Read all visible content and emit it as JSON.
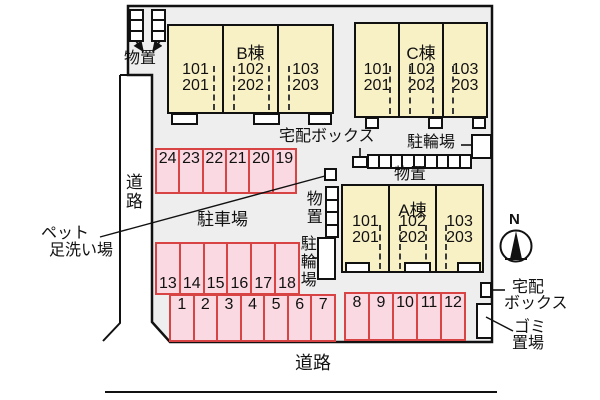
{
  "colors": {
    "background": "#ffffff",
    "site_fill": "#eeeeee",
    "line": "#111111",
    "text": "#111111",
    "building_fill": "#f9f1c6",
    "parking_fill": "#fbd9e2",
    "parking_border": "#d84444"
  },
  "roads": {
    "left": "道路",
    "bottom": "道路"
  },
  "buildings": [
    {
      "name": "B棟",
      "units": [
        {
          "l1": "101",
          "l2": "201"
        },
        {
          "l1": "102",
          "l2": "202"
        },
        {
          "l1": "103",
          "l2": "203"
        }
      ]
    },
    {
      "name": "C棟",
      "units": [
        {
          "l1": "101",
          "l2": "201"
        },
        {
          "l1": "102",
          "l2": "202"
        },
        {
          "l1": "103",
          "l2": "203"
        }
      ]
    },
    {
      "name": "A棟",
      "units": [
        {
          "l1": "101",
          "l2": "201"
        },
        {
          "l1": "102",
          "l2": "202"
        },
        {
          "l1": "103",
          "l2": "203"
        }
      ]
    }
  ],
  "parking": {
    "area_label": "駐車場",
    "row_back": [
      "24",
      "23",
      "22",
      "21",
      "20",
      "19"
    ],
    "row_mid": [
      "13",
      "14",
      "15",
      "16",
      "17",
      "18"
    ],
    "row_front_left": [
      "1",
      "2",
      "3",
      "4",
      "5",
      "6",
      "7"
    ],
    "row_front_right": [
      "8",
      "9",
      "10",
      "11",
      "12"
    ]
  },
  "facilities": {
    "storage_top": "物置",
    "delivery_box_top": "宅配ボックス",
    "bicycle_top": "駐輪場",
    "storage_row": "物置",
    "storage_mid": "物置",
    "bicycle_mid": "駐輪場",
    "pet_wash_l1": "ペット",
    "pet_wash_l2": "足洗い場",
    "delivery_box_right_l1": "宅配",
    "delivery_box_right_l2": "ボックス",
    "garbage_l1": "ゴミ",
    "garbage_l2": "置場"
  },
  "compass": {
    "north": "N"
  }
}
